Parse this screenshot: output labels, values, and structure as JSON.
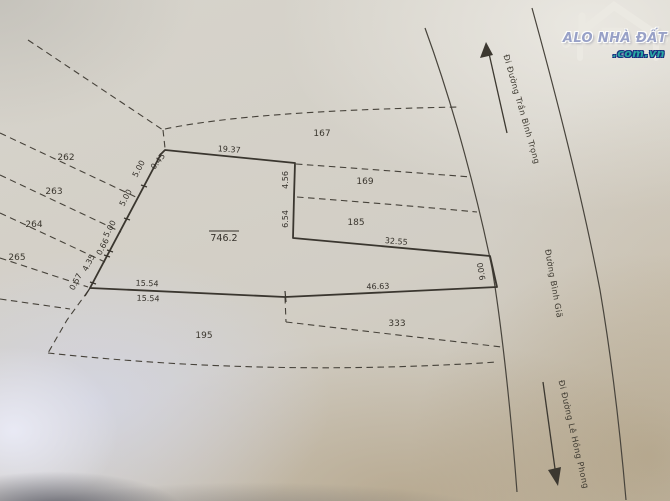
{
  "logo": {
    "title": "ALO NHÀ ĐẤT",
    "domain": ".com.vn"
  },
  "roads": {
    "to_top": "Đi Đường Trần Bình Trọng",
    "name": "Đường Bình Giã",
    "to_bottom": "Đi Đường Lê Hồng Phong"
  },
  "parcel": {
    "area": "746.2"
  },
  "dims": {
    "d045": "0.45",
    "d1937": "19.37",
    "d456": "4.56",
    "d654": "6.54",
    "d3255": "32.55",
    "d900": "9.00",
    "d1554a": "15.54",
    "d1554b": "15.54",
    "d4663": "46.63",
    "d057": "0.57",
    "d435": "4.35",
    "d066": "0.66",
    "d500a": "5.00",
    "d500b": "5.00",
    "d500c": "5.00"
  },
  "neighbors": {
    "n262": "262",
    "n263": "263",
    "n264": "264",
    "n265": "265",
    "n167": "167",
    "n169": "169",
    "n185": "185",
    "n195": "195",
    "n333": "333"
  },
  "colors": {
    "ink": "#3a362f",
    "paper": "#d2cec5",
    "logo_title": "#98a1c7",
    "logo_domain": "#2aa7a2"
  }
}
